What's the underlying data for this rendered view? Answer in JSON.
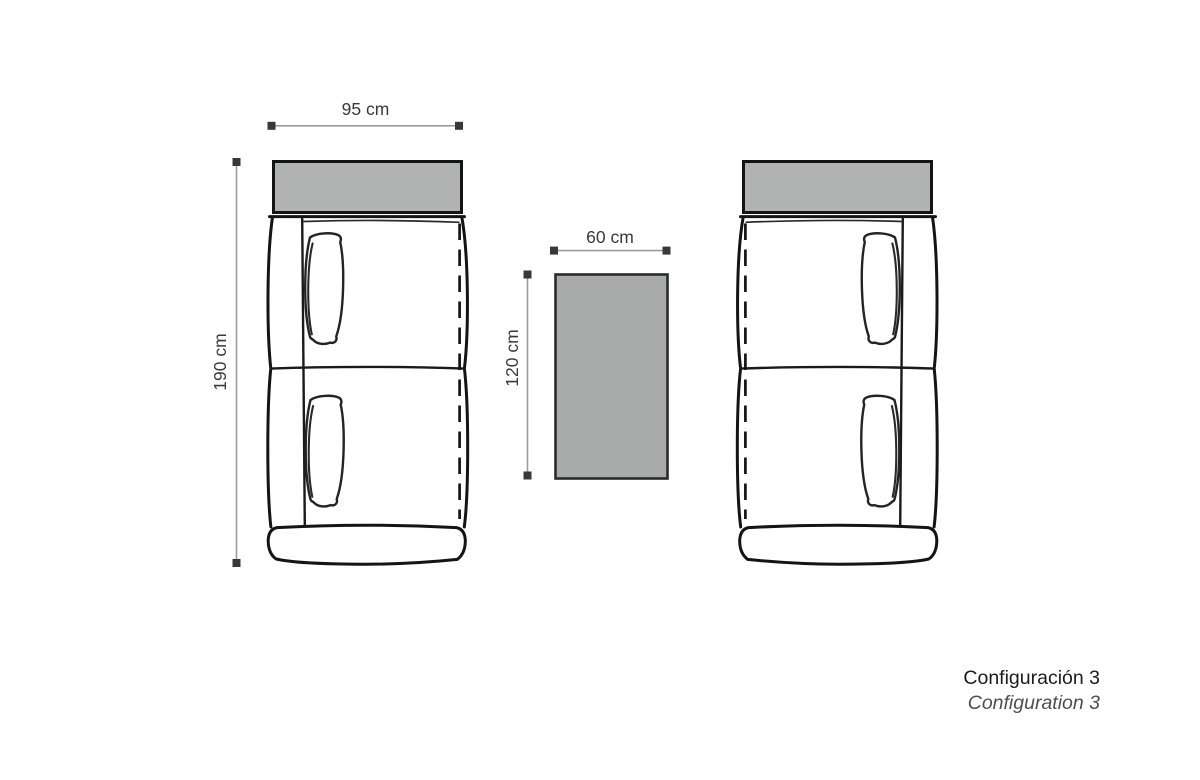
{
  "labels": {
    "sofa_width": "95 cm",
    "sofa_depth": "190 cm",
    "table_width": "60 cm",
    "table_depth": "120 cm"
  },
  "caption": {
    "primary": "Configuración 3",
    "secondary": "Configuration 3"
  },
  "colors": {
    "backrest_fill": "#b1b3b2",
    "table_fill": "#a9abaa",
    "outline": "#141414",
    "dimension_line": "#9b9b9b",
    "dimension_marker": "#383838",
    "dimension_text": "#3a3a3a",
    "caption_primary": "#1c1c1c",
    "caption_secondary": "#4f4f4f"
  }
}
